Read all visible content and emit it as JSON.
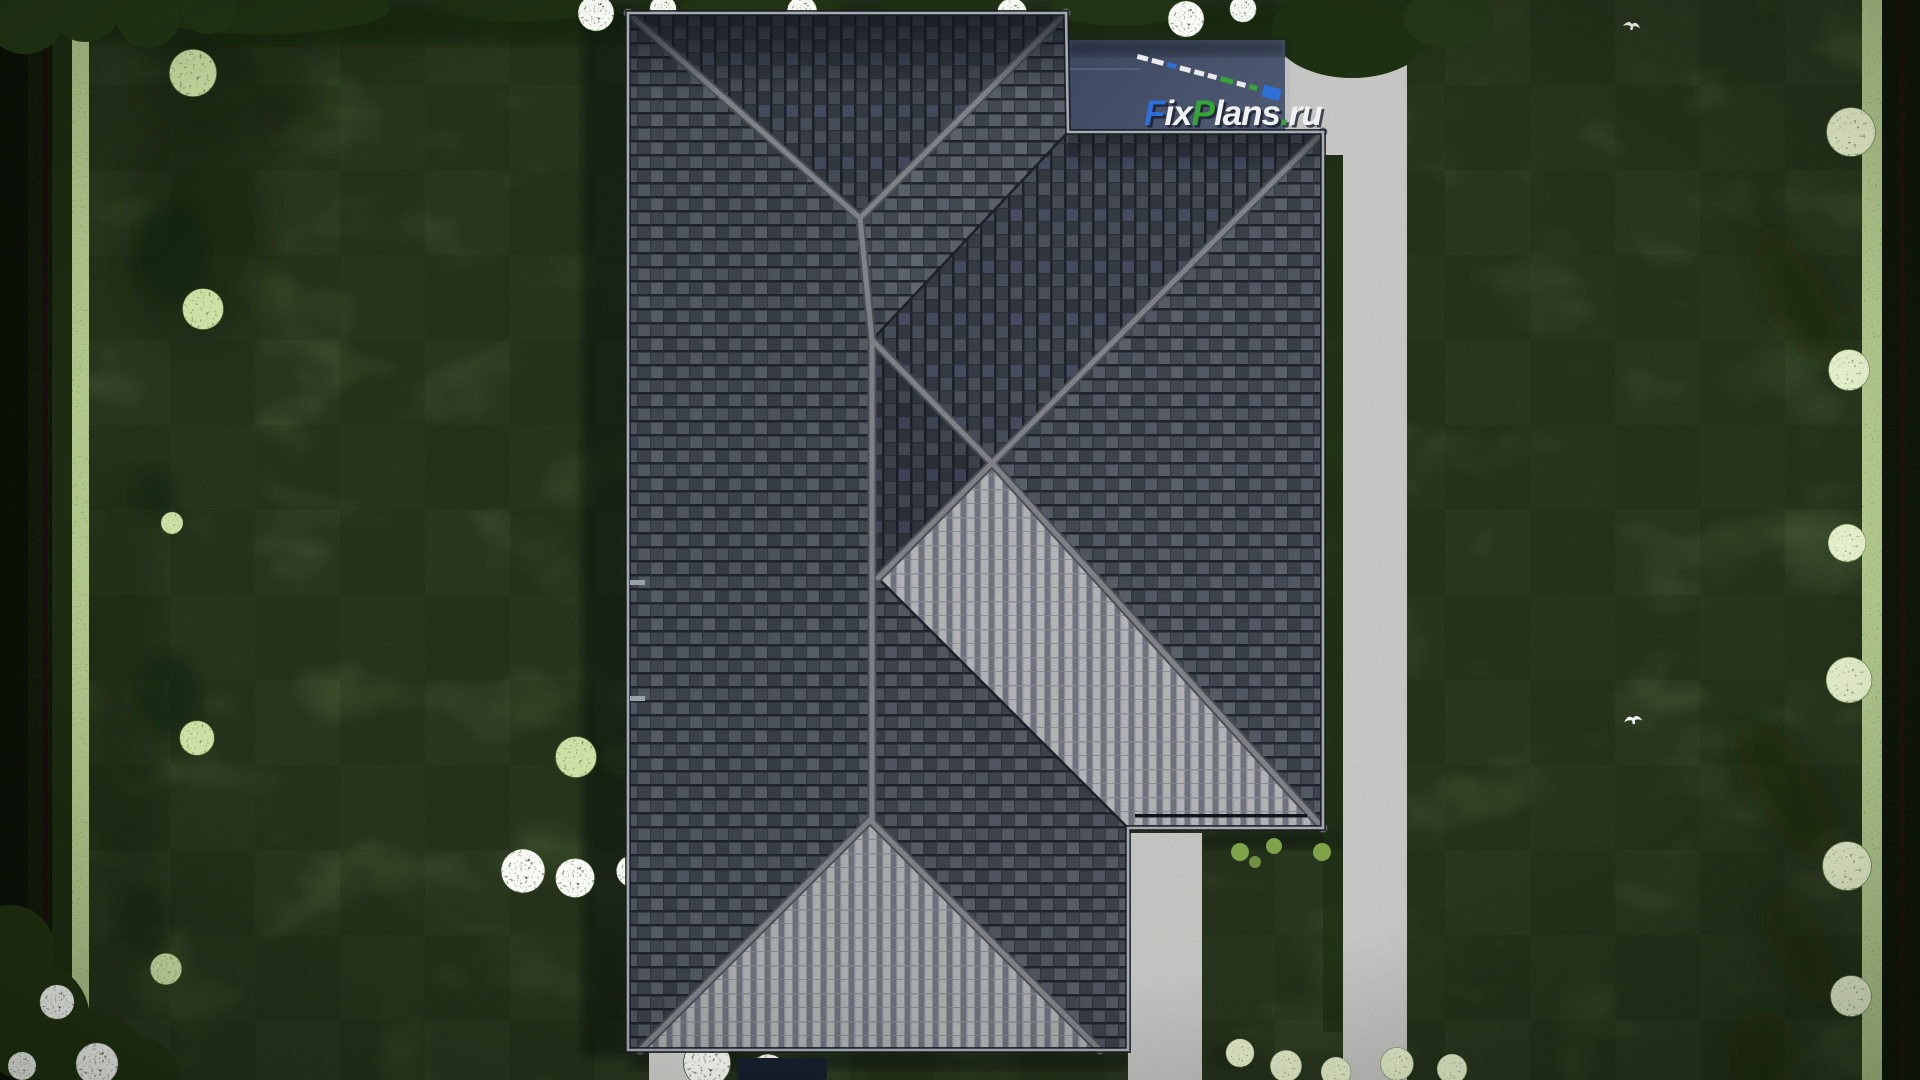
{
  "watermark": {
    "full": "FixPlans.ru",
    "f": "F",
    "ix": "ix",
    "p": "P",
    "lans": "lans",
    "dot": ".",
    "ru": "ru"
  },
  "watermark_colors": {
    "blue": "#2e6fd8",
    "green": "#37a43a",
    "white": "#f0f1f3",
    "shadow": "#141a26"
  },
  "scalebar": {
    "c0": "#e8eaec",
    "c1": "#e8eaec",
    "c2": "#2e6fd8",
    "c3": "#e8eaec",
    "c4": "#e8eaec",
    "c5": "#e8eaec",
    "c6": "#37a43a",
    "c7": "#e8eaec",
    "c8": "#37a43a",
    "c9": "#2e6fd8"
  },
  "palette": {
    "lawn": "#5a7742",
    "lawn_shadow": "#22371a",
    "hedge_dark": "#1c2a15",
    "hedge_bright": "#7fa04f",
    "roof_tile": "#5d6470",
    "roof_tile_dark": "#3f4550",
    "roof_tile_bright": "#dfe1e5",
    "ridge_gray": "#a2a6ad",
    "concrete": "#d8d8d5",
    "terrace_slate": "#434e68",
    "bush_sage": "#a9bf85",
    "flower_white": "#e9efe4"
  },
  "scene": {
    "type": "aerial-architectural-render",
    "elements": [
      "lawn",
      "hip-roof-house",
      "flat-terrace",
      "driveway",
      "left-hedge",
      "right-hedge",
      "top-trees",
      "garden-bushes",
      "white-flower-bushes",
      "birds"
    ]
  }
}
